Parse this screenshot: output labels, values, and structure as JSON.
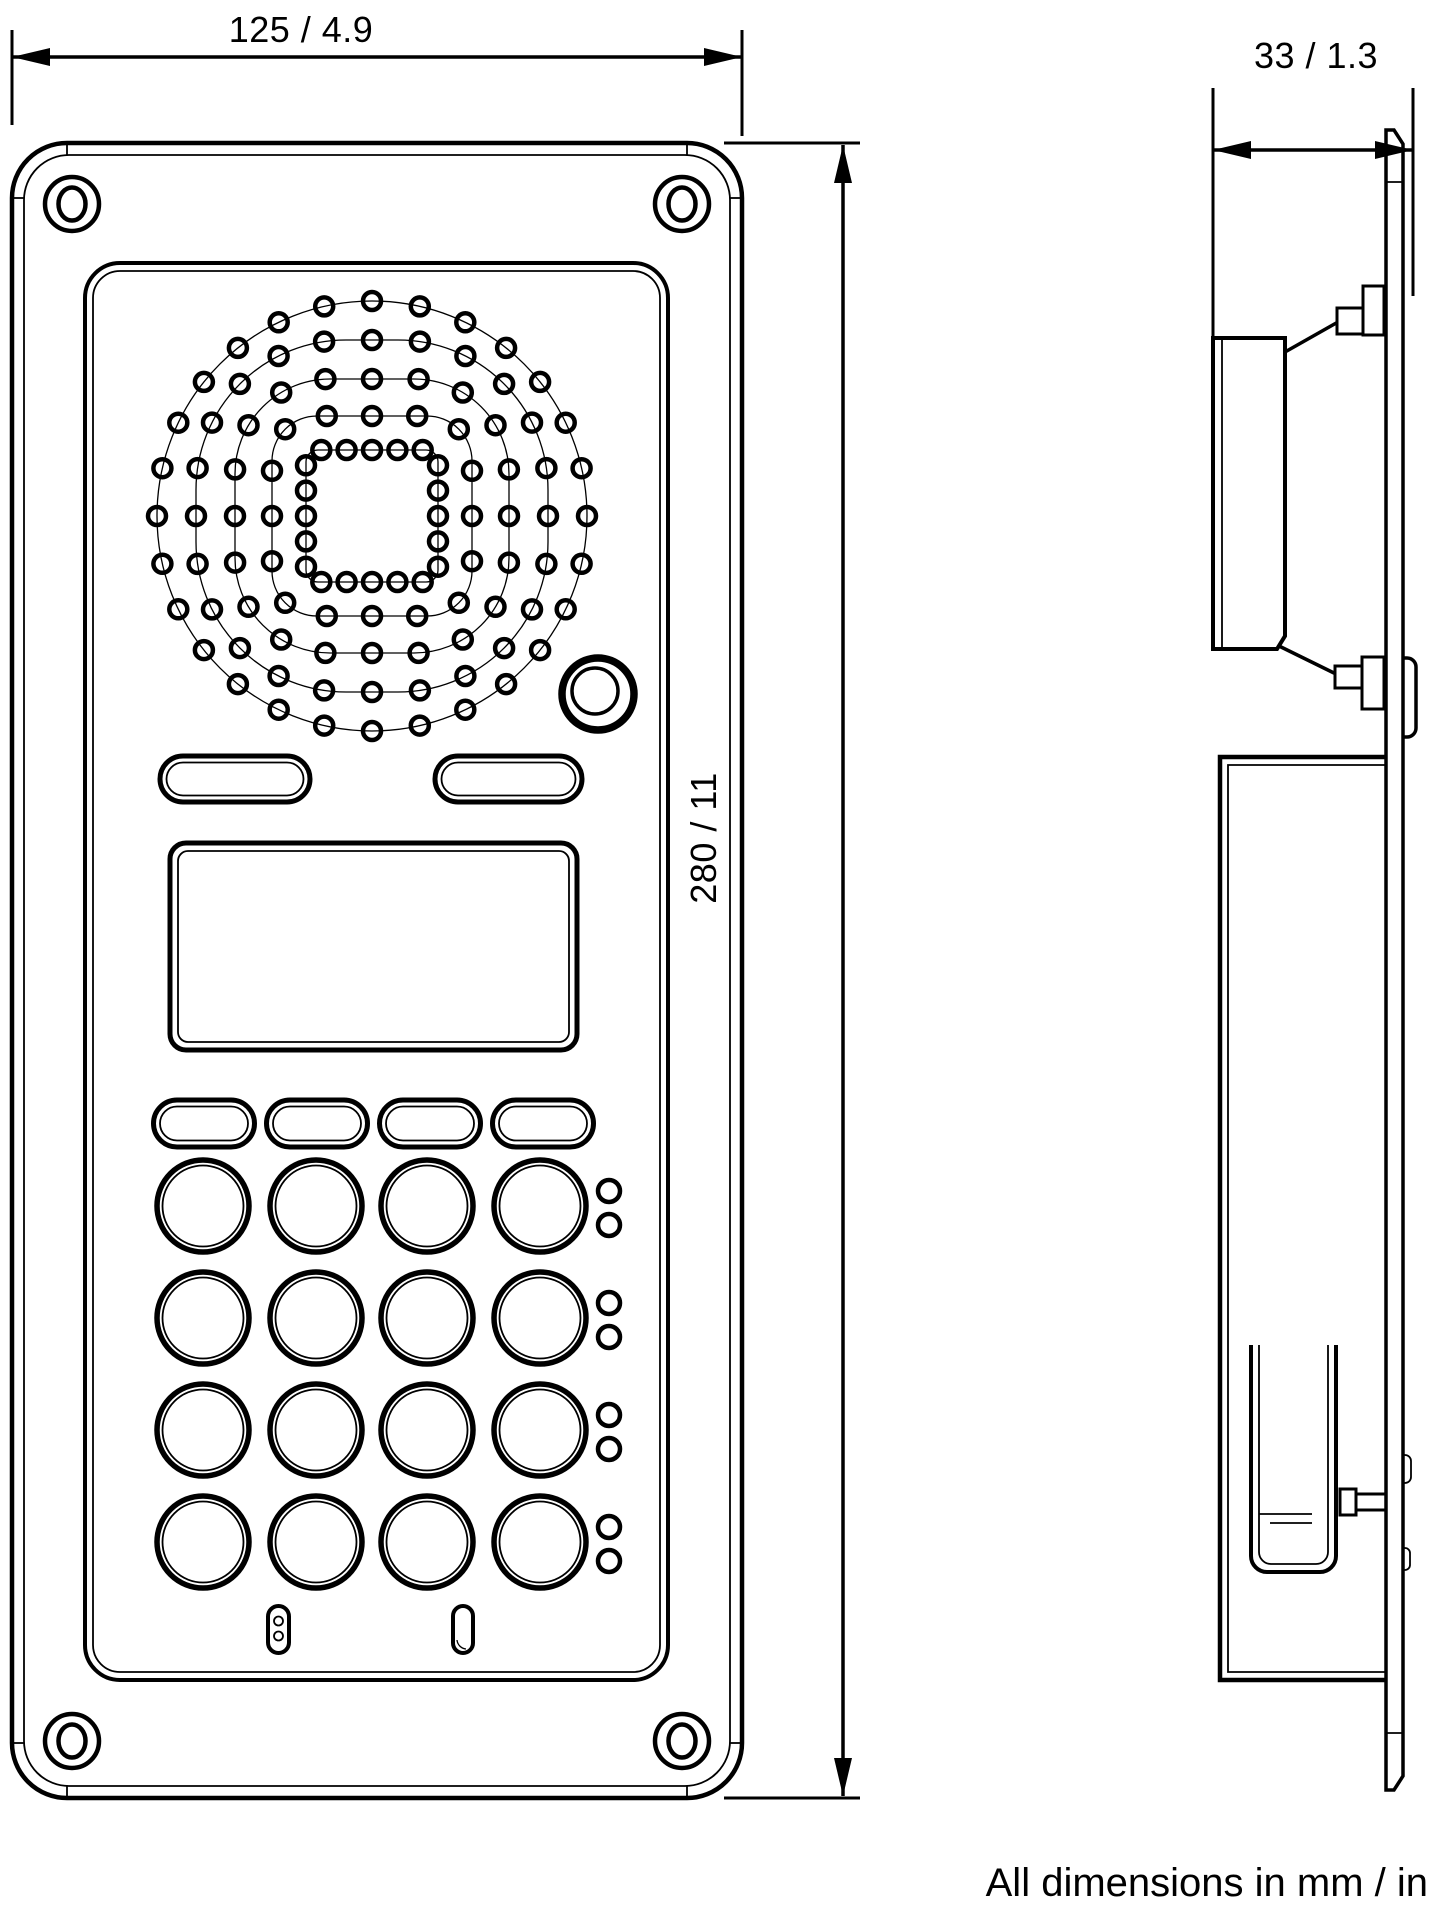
{
  "note": "All dimensions in mm / in",
  "dimensions": {
    "width": "125 / 4.9",
    "height": "280 / 11",
    "depth": "33 / 1.3"
  },
  "front_view": {
    "corner_screws": [
      [
        72,
        204
      ],
      [
        682,
        204
      ],
      [
        72,
        1741
      ],
      [
        682,
        1741
      ]
    ],
    "speaker_grille": {
      "center": [
        372,
        516
      ],
      "hole_radius": 9,
      "rings": [
        {
          "half": 215,
          "corner": 215,
          "holes": 28
        },
        {
          "half": 176,
          "corner": 150,
          "holes": 24
        },
        {
          "half": 137,
          "corner": 95,
          "holes": 20
        },
        {
          "half": 100,
          "corner": 45,
          "holes": 16
        },
        {
          "half": 66,
          "corner": 12,
          "holes": 20
        }
      ]
    },
    "camera": {
      "center": [
        598,
        694
      ],
      "outer_r": 36,
      "inner_r": 23
    },
    "call_buttons": {
      "y": 756,
      "h": 46,
      "items": [
        {
          "x": 160,
          "w": 150
        },
        {
          "x": 435,
          "w": 147
        }
      ]
    },
    "softkeys": {
      "centers": [
        204,
        317,
        430,
        543
      ],
      "y": 1100,
      "w": 101,
      "h": 47
    },
    "keypad": {
      "col_centers": [
        203,
        316,
        427,
        540
      ],
      "row_centers": [
        1206,
        1318,
        1430,
        1542
      ],
      "r": 46
    },
    "led_pairs": {
      "cx": 609,
      "r": 11,
      "dy": [
        -15,
        19
      ]
    },
    "mic_slots": 2
  },
  "side_view": {
    "features": [
      "front-plate",
      "speaker-box",
      "speaker-cone",
      "mounting-studs",
      "back-box",
      "bottom-bracket",
      "lens-bump"
    ]
  }
}
